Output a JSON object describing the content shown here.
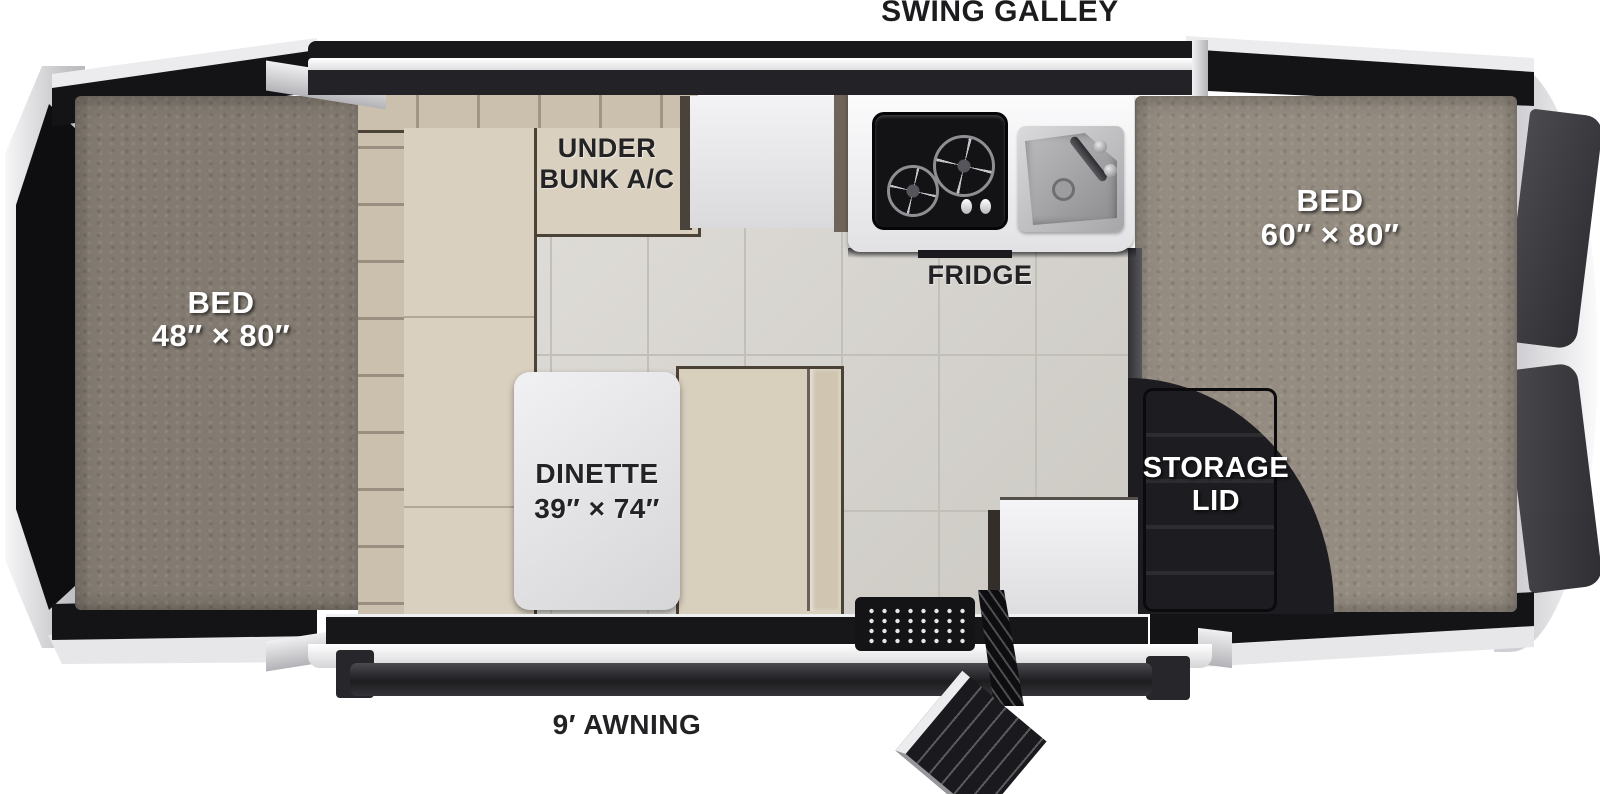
{
  "galley": {
    "label": "SWING GALLEY"
  },
  "awning": {
    "label": "9′ AWNING"
  },
  "fridge": {
    "label": "FRIDGE"
  },
  "bed_left": {
    "name": "BED",
    "size": "48″ × 80″"
  },
  "bed_right": {
    "name": "BED",
    "size": "60″ × 80″"
  },
  "bunk_ac": {
    "line1": "UNDER",
    "line2": "BUNK A/C"
  },
  "dinette": {
    "name": "DINETTE",
    "size": "39″ × 74″"
  },
  "storage": {
    "line1": "STORAGE",
    "line2": "LID"
  },
  "colors": {
    "body_black": "#17171a",
    "frame_silver": "#d2d2d5",
    "carpet_left": "#837b71",
    "carpet_right": "#948c81",
    "cushion_beige": "#d9d0bf",
    "floor_tile": "#d7d4ce",
    "counter_white": "#f2f2f4",
    "label_dark": "#232326",
    "label_light": "#ffffff"
  }
}
